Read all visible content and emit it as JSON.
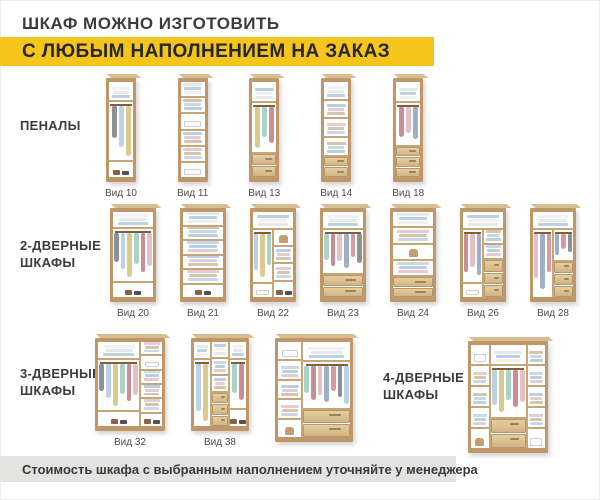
{
  "header": {
    "title": "ШКАФ МОЖНО ИЗГОТОВИТЬ",
    "banner": "С ЛЮБЫМ НАПОЛНЕНИЕМ НА ЗАКАЗ"
  },
  "footer": {
    "note": "Стоимость шкафа с выбранным наполнением уточняйте у менеджера"
  },
  "palette": {
    "accent_yellow": "#f6c51b",
    "bar_gray": "#e3e3e1",
    "text_dark": "#3c3c3c",
    "wood": "#c09768",
    "wood_mid": "#c9a474",
    "wood_light": "#d9bd92",
    "garments": [
      "#d79aa3",
      "#8f8f98",
      "#b9d2e4",
      "#dcc98e",
      "#a8d3c5",
      "#c98d96",
      "#e7bfc5",
      "#9db0c4"
    ],
    "linens": [
      "#f1f1f1",
      "#e4e9ee",
      "#bcd2e2"
    ],
    "stacks": [
      "#b9cfe2",
      "#e3ccd3",
      "#d6c5ac",
      "#c7d9e8"
    ]
  },
  "rows": [
    {
      "label": "ПЕНАЛЫ",
      "items": [
        {
          "label": "Вид 10",
          "w": 30,
          "h": 104,
          "cols": [
            {
              "w": 1,
              "cells": [
                {
                  "t": "linen",
                  "h": 1
                },
                {
                  "t": "hang",
                  "h": 3.6
                },
                {
                  "t": "shoe",
                  "h": 0.8
                }
              ]
            }
          ]
        },
        {
          "label": "Вид 11",
          "w": 30,
          "h": 104,
          "cols": [
            {
              "w": 1,
              "cells": [
                {
                  "t": "linen",
                  "h": 1
                },
                {
                  "t": "stack",
                  "h": 1
                },
                {
                  "t": "box",
                  "h": 1
                },
                {
                  "t": "stack",
                  "h": 1
                },
                {
                  "t": "stack",
                  "h": 1
                },
                {
                  "t": "box",
                  "h": 1
                }
              ]
            }
          ]
        },
        {
          "label": "Вид 13",
          "w": 30,
          "h": 104,
          "cols": [
            {
              "w": 1,
              "cells": [
                {
                  "t": "linen",
                  "h": 1
                },
                {
                  "t": "hang",
                  "h": 2.8
                },
                {
                  "t": "dr2",
                  "h": 1.3
                }
              ]
            }
          ]
        },
        {
          "label": "Вид 14",
          "w": 30,
          "h": 104,
          "cols": [
            {
              "w": 1,
              "cells": [
                {
                  "t": "linen",
                  "h": 1
                },
                {
                  "t": "stack",
                  "h": 1
                },
                {
                  "t": "stack",
                  "h": 1
                },
                {
                  "t": "stack",
                  "h": 1
                },
                {
                  "t": "dr2",
                  "h": 1.4
                }
              ]
            }
          ]
        },
        {
          "label": "Вид 18",
          "w": 30,
          "h": 104,
          "cols": [
            {
              "w": 1,
              "cells": [
                {
                  "t": "linen",
                  "h": 1
                },
                {
                  "t": "hang",
                  "h": 2.5
                },
                {
                  "t": "dr3",
                  "h": 1.8
                }
              ]
            }
          ]
        }
      ]
    },
    {
      "label": "2-ДВЕРНЫЕ ШКАФЫ",
      "items": [
        {
          "label": "Вид 20",
          "w": 46,
          "h": 94,
          "cols": [
            {
              "w": 1,
              "cells": [
                {
                  "t": "linen",
                  "h": 1
                },
                {
                  "t": "hang",
                  "h": 4
                },
                {
                  "t": "shoe",
                  "h": 0.9
                }
              ]
            }
          ]
        },
        {
          "label": "Вид 21",
          "w": 46,
          "h": 94,
          "cols": [
            {
              "w": 1,
              "cells": [
                {
                  "t": "linen",
                  "h": 1
                },
                {
                  "t": "stack",
                  "h": 1
                },
                {
                  "t": "stack",
                  "h": 1
                },
                {
                  "t": "stack",
                  "h": 1
                },
                {
                  "t": "stack",
                  "h": 1
                },
                {
                  "t": "shoe",
                  "h": 1
                }
              ]
            }
          ]
        },
        {
          "label": "Вид 22",
          "w": 46,
          "h": 94,
          "top": {
            "t": "linen",
            "h": 1
          },
          "colsh": 5,
          "cols": [
            {
              "w": 1,
              "cells": [
                {
                  "t": "hang",
                  "h": 4.2
                },
                {
                  "t": "box",
                  "h": 0.9
                }
              ]
            },
            {
              "w": 1,
              "cells": [
                {
                  "t": "bag",
                  "h": 1
                },
                {
                  "t": "stack",
                  "h": 1
                },
                {
                  "t": "stack",
                  "h": 1
                },
                {
                  "t": "shoe",
                  "h": 1
                }
              ]
            }
          ]
        },
        {
          "label": "Вид 23",
          "w": 46,
          "h": 94,
          "cols": [
            {
              "w": 1,
              "cells": [
                {
                  "t": "linen",
                  "h": 1
                },
                {
                  "t": "hang",
                  "h": 3
                },
                {
                  "t": "dr2",
                  "h": 1.5
                }
              ]
            }
          ]
        },
        {
          "label": "Вид 24",
          "w": 46,
          "h": 94,
          "cols": [
            {
              "w": 1,
              "cells": [
                {
                  "t": "linen",
                  "h": 1
                },
                {
                  "t": "stack",
                  "h": 1
                },
                {
                  "t": "bag",
                  "h": 1
                },
                {
                  "t": "stack",
                  "h": 1
                },
                {
                  "t": "dr2",
                  "h": 1.6
                }
              ]
            }
          ]
        },
        {
          "label": "Вид 26",
          "w": 46,
          "h": 94,
          "top": {
            "t": "linen",
            "h": 1
          },
          "colsh": 5,
          "cols": [
            {
              "w": 1,
              "cells": [
                {
                  "t": "hang",
                  "h": 4.2
                },
                {
                  "t": "box",
                  "h": 0.9
                }
              ]
            },
            {
              "w": 1,
              "cells": [
                {
                  "t": "stack",
                  "h": 0.8
                },
                {
                  "t": "stack",
                  "h": 0.8
                },
                {
                  "t": "dr3",
                  "h": 2.6
                }
              ]
            }
          ]
        },
        {
          "label": "Вид 28",
          "w": 46,
          "h": 94,
          "top": {
            "t": "linen",
            "h": 1
          },
          "colsh": 5,
          "cols": [
            {
              "w": 1,
              "cells": [
                {
                  "t": "hang",
                  "h": 5.2
                }
              ]
            },
            {
              "w": 1,
              "cells": [
                {
                  "t": "hang",
                  "h": 2.4
                },
                {
                  "t": "dr3",
                  "h": 2.8
                }
              ]
            }
          ]
        }
      ]
    },
    {
      "label": "3-ДВЕРНЫЕ ШКАФЫ",
      "items": [
        {
          "label": "Вид 32",
          "w": 70,
          "h": 93,
          "cols": [
            {
              "w": 2,
              "cells": [
                {
                  "t": "linen",
                  "h": 1
                },
                {
                  "t": "hang",
                  "h": 3.7
                },
                {
                  "t": "shoe",
                  "h": 0.9
                }
              ]
            },
            {
              "w": 1,
              "cells": [
                {
                  "t": "stack",
                  "h": 1
                },
                {
                  "t": "box",
                  "h": 1
                },
                {
                  "t": "stack",
                  "h": 1
                },
                {
                  "t": "stack",
                  "h": 1
                },
                {
                  "t": "stack",
                  "h": 1
                },
                {
                  "t": "shoe",
                  "h": 1
                }
              ]
            }
          ]
        },
        {
          "label": "Вид 38",
          "w": 58,
          "h": 93,
          "cols": [
            {
              "w": 1,
              "cells": [
                {
                  "t": "linen",
                  "h": 1
                },
                {
                  "t": "hang",
                  "h": 4.6
                }
              ]
            },
            {
              "w": 1,
              "cells": [
                {
                  "t": "linen",
                  "h": 1
                },
                {
                  "t": "stack",
                  "h": 1
                },
                {
                  "t": "stack",
                  "h": 1
                },
                {
                  "t": "dr3",
                  "h": 2.6
                }
              ]
            },
            {
              "w": 1,
              "cells": [
                {
                  "t": "linen",
                  "h": 1
                },
                {
                  "t": "hang",
                  "h": 3.6
                },
                {
                  "t": "shoe",
                  "h": 1
                }
              ]
            }
          ]
        },
        {
          "label": "",
          "w": 78,
          "h": 104,
          "cols": [
            {
              "w": 1,
              "cells": [
                {
                  "t": "box",
                  "h": 1
                },
                {
                  "t": "stack",
                  "h": 1
                },
                {
                  "t": "stack",
                  "h": 1
                },
                {
                  "t": "stack",
                  "h": 1
                },
                {
                  "t": "bag",
                  "h": 1
                }
              ]
            },
            {
              "w": 2,
              "cells": [
                {
                  "t": "linen",
                  "h": 1
                },
                {
                  "t": "hang",
                  "h": 2.9
                },
                {
                  "t": "dr2",
                  "h": 1.7
                }
              ]
            }
          ]
        }
      ]
    },
    {
      "label": "4-ДВЕРНЫЕ ШКАФЫ",
      "items": [
        {
          "label": "",
          "w": 80,
          "h": 112,
          "cols": [
            {
              "w": 1,
              "cells": [
                {
                  "t": "box",
                  "h": 1
                },
                {
                  "t": "stack",
                  "h": 1
                },
                {
                  "t": "stack",
                  "h": 1
                },
                {
                  "t": "stack",
                  "h": 1
                },
                {
                  "t": "bag",
                  "h": 1
                }
              ]
            },
            {
              "w": 2,
              "cells": [
                {
                  "t": "linen",
                  "h": 1
                },
                {
                  "t": "hang",
                  "h": 2.9
                },
                {
                  "t": "dr2",
                  "h": 1.7
                }
              ]
            },
            {
              "w": 1,
              "cells": [
                {
                  "t": "stack",
                  "h": 1
                },
                {
                  "t": "stack",
                  "h": 1
                },
                {
                  "t": "stack",
                  "h": 1
                },
                {
                  "t": "stack",
                  "h": 1
                },
                {
                  "t": "box",
                  "h": 1
                }
              ]
            }
          ]
        }
      ]
    }
  ]
}
